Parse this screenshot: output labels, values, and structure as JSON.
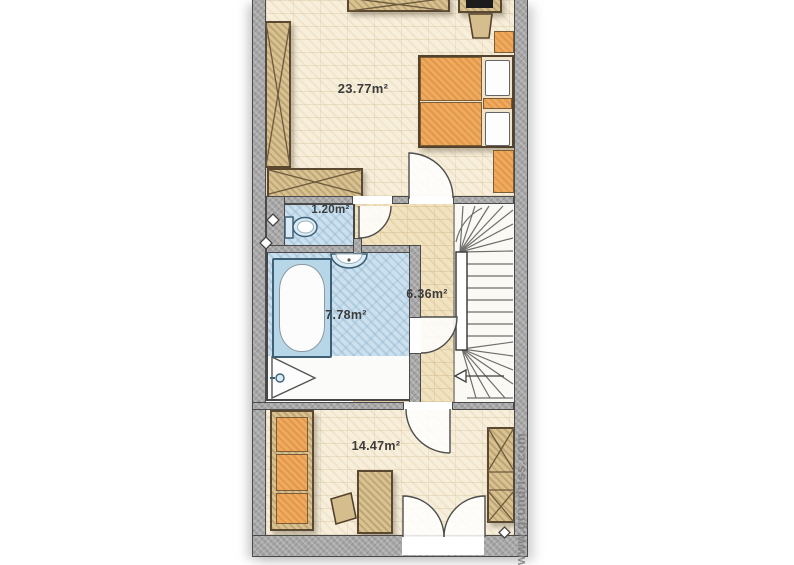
{
  "rooms": {
    "bedroom": {
      "name": "bedroom",
      "area": "23.77m²"
    },
    "wc": {
      "name": "wc",
      "area": "1.20m²"
    },
    "bathroom": {
      "name": "bathroom",
      "area": "7.78m²"
    },
    "hallway": {
      "name": "hallway",
      "area": "6.36m²"
    },
    "room_bottom": {
      "name": "room-bottom",
      "area": "14.47m²"
    }
  },
  "watermark": {
    "text": "www.grundriss.com"
  },
  "colors": {
    "wall": "#a6a6a6",
    "floor_cream": "#f7efdc",
    "floor_beige": "#f1e2c0",
    "floor_blue": "#cde0ee",
    "wood": "#d9c291",
    "upholstery_orange": "#eeaa60",
    "fixture_blue": "#d9ebf5",
    "label_text": "#3c3c3c"
  }
}
